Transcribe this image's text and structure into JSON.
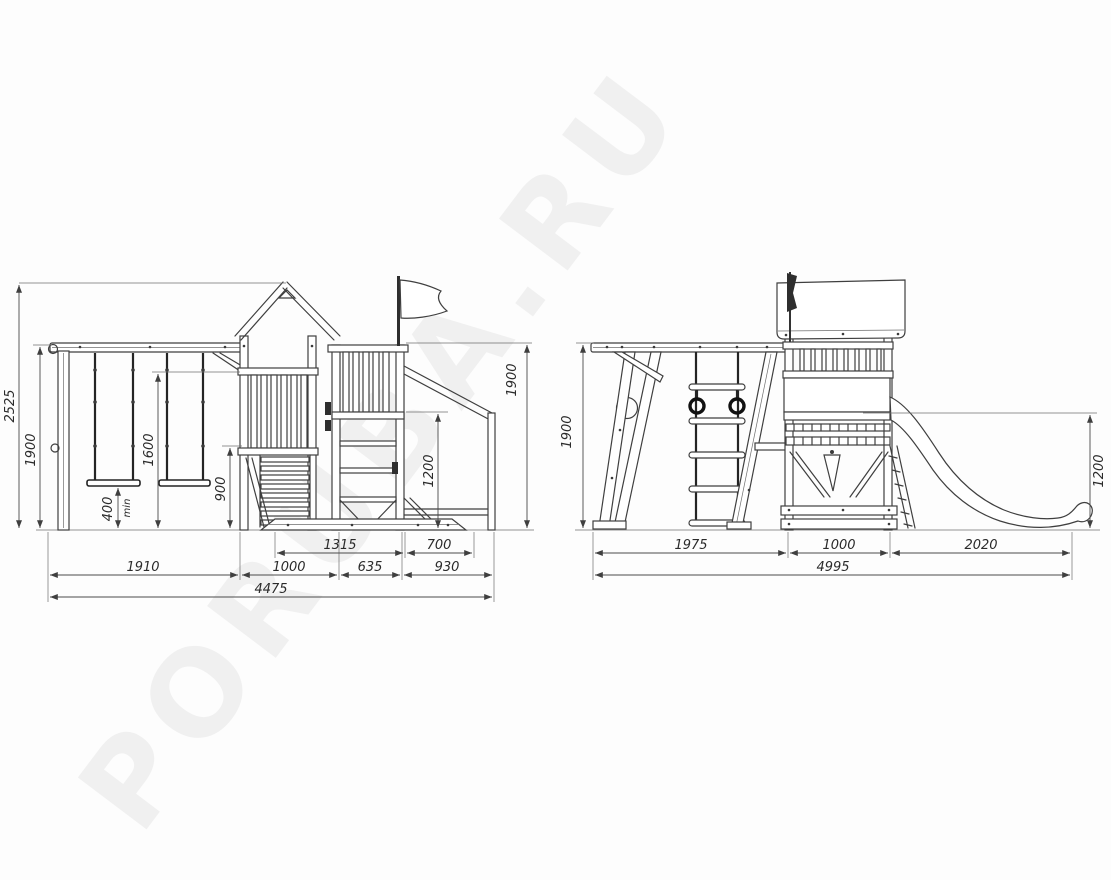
{
  "watermark": "PORUBA.RU",
  "front_view": {
    "name": "front-elevation",
    "dims": {
      "total_height": "2525",
      "swing_beam_height": "1900",
      "guardrail_height": "1600",
      "swing_seat_clearance": "400",
      "swing_seat_clearance_note": "min",
      "platform_height": "900",
      "slide_platform_height": "1200",
      "tower_top_height": "1900",
      "row1": [
        "1315",
        "700"
      ],
      "row2": [
        "1910",
        "1000",
        "635",
        "930"
      ],
      "total_width": "4475"
    }
  },
  "side_view": {
    "name": "side-elevation",
    "dims": {
      "frame_height": "1900",
      "slide_start_height": "1200",
      "row1": [
        "1975",
        "1000",
        "2020"
      ],
      "total_width": "4995"
    }
  }
}
